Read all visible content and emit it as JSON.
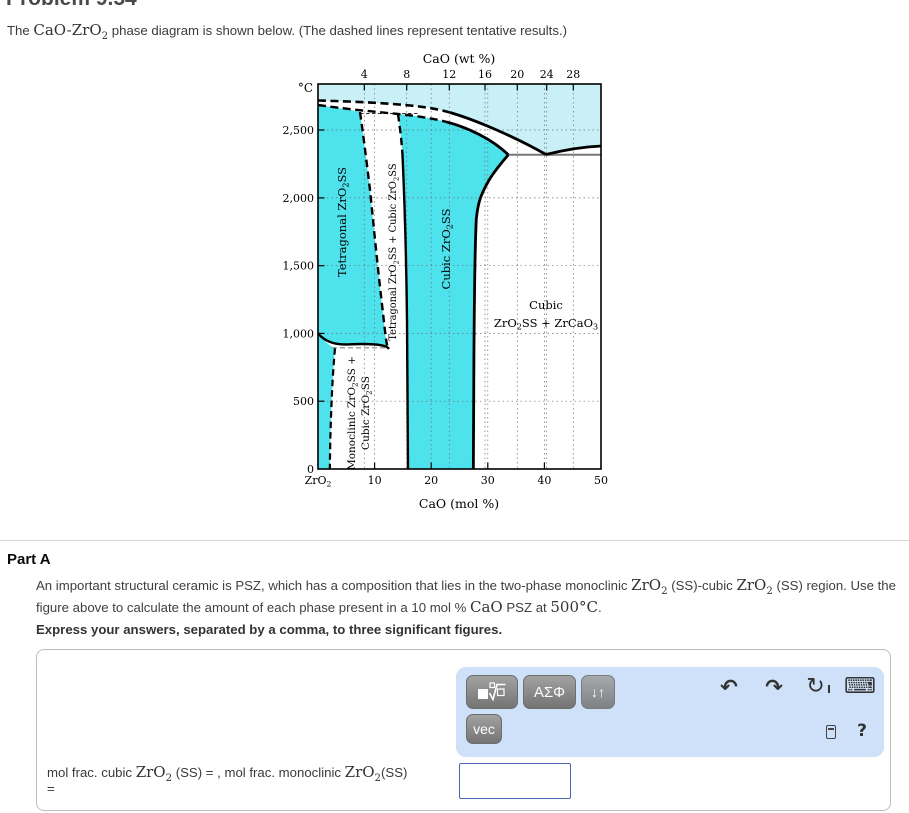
{
  "theme": {
    "cyan": "#4ee2ec",
    "cyan-light": "#c9f0f6",
    "toolbar-bg": "#cee1f8",
    "btn-top": "#a2a2a2",
    "btn-bottom": "#747474",
    "input-border": "#4a66b0",
    "icon": "#333333",
    "panel-border": "#bdbdbd"
  },
  "page": {
    "title_clipped": "Problem 9.54"
  },
  "intro": "The `CaO-ZrO_2` phase diagram is shown below. (The dashed lines represent tentative results.)",
  "figure": {
    "top_axis_title": "CaO (wt %)",
    "bottom_axis_title": "CaO (mol %)",
    "y_unit": "°C",
    "top_ticks": [
      "4",
      "8",
      "12",
      "16",
      "20",
      "24",
      "28"
    ],
    "bottom_ticks": [
      "ZrO_2",
      "10",
      "20",
      "30",
      "40",
      "50"
    ],
    "left_ticks": [
      "0",
      "500",
      "1,000",
      "1,500",
      "2,000",
      "2,500"
    ],
    "regions": {
      "tetragonal": "Tetragonal ZrO_2SS",
      "tetra_cubic": "Tetragonal ZrO_2SS + Cubic ZrO_2SS",
      "cubic": "Cubic ZrO_2SS",
      "mono_line1": "Monoclinic ZrO_2SS +",
      "mono_line2": "Cubic ZrO_2SS",
      "cubic_zrcao3_line1": "Cubic",
      "cubic_zrcao3_line2": "ZrO_2SS + ZrCaO_3"
    }
  },
  "chart_data": {
    "type": "line",
    "title": "CaO-ZrO2 phase diagram",
    "xlabel": "CaO (mol %)",
    "xlabel_top": "CaO (wt %)",
    "ylabel": "Temperature (°C)",
    "xlim": [
      0,
      50
    ],
    "ylim": [
      0,
      2840
    ],
    "x_ticks_mol": [
      0,
      10,
      20,
      30,
      40,
      50
    ],
    "x_ticks_wt": [
      4,
      8,
      12,
      16,
      20,
      24,
      28
    ],
    "y_ticks": [
      0,
      500,
      1000,
      1500,
      2000,
      2500
    ],
    "grid": true,
    "regions": [
      "Liquid",
      "Tetragonal ZrO2SS",
      "Tetragonal ZrO2SS + Cubic ZrO2SS",
      "Cubic ZrO2SS",
      "Cubic ZrO2SS + ZrCaO3",
      "Monoclinic ZrO2SS + Cubic ZrO2SS",
      "Monoclinic ZrO2SS"
    ],
    "series": [
      {
        "name": "liquidus (dashed, tentative)",
        "style": "dashed",
        "points": [
          [
            0,
            2718
          ],
          [
            8,
            2695
          ],
          [
            16,
            2672
          ],
          [
            22,
            2630
          ],
          [
            30,
            2480
          ],
          [
            40,
            2300
          ]
        ]
      },
      {
        "name": "liquidus right branch",
        "style": "solid",
        "points": [
          [
            40,
            2300
          ],
          [
            45,
            2345
          ],
          [
            50,
            2382
          ]
        ]
      },
      {
        "name": "solidus",
        "style": "dashed-then-solid",
        "points": [
          [
            0,
            2684
          ],
          [
            8,
            2650
          ],
          [
            14,
            2618
          ],
          [
            22,
            2560
          ],
          [
            28,
            2450
          ],
          [
            33.6,
            2300
          ]
        ]
      },
      {
        "name": "tetragonal solvus (dashed)",
        "style": "dashed",
        "points": [
          [
            7.4,
            2630
          ],
          [
            9,
            2050
          ],
          [
            11.5,
            1150
          ],
          [
            12.2,
            910
          ]
        ]
      },
      {
        "name": "cubic solvus",
        "style": "dashed-then-solid",
        "points": [
          [
            14.1,
            2600
          ],
          [
            14.9,
            2300
          ],
          [
            15.6,
            1500
          ],
          [
            15.8,
            500
          ],
          [
            15.9,
            0
          ]
        ]
      },
      {
        "name": "cubic right boundary",
        "style": "solid",
        "points": [
          [
            33.6,
            2300
          ],
          [
            29.8,
            2100
          ],
          [
            28,
            2000
          ],
          [
            27.6,
            1500
          ],
          [
            27.4,
            0
          ]
        ]
      },
      {
        "name": "monoclinic-tetragonal boundary",
        "style": "solid",
        "points": [
          [
            0,
            1000
          ],
          [
            5,
            925
          ],
          [
            12.5,
            905
          ]
        ]
      },
      {
        "name": "monoclinic solvus (dashed)",
        "style": "dashed",
        "points": [
          [
            3,
            890
          ],
          [
            2.1,
            500
          ],
          [
            2.1,
            0
          ]
        ]
      },
      {
        "name": "eutectoid isotherm ~900°C (dashed)",
        "style": "dashed",
        "points": [
          [
            2.5,
            900
          ],
          [
            12.5,
            900
          ]
        ]
      },
      {
        "name": "isotherm 2300°C",
        "style": "solid",
        "points": [
          [
            33.6,
            2300
          ],
          [
            50,
            2300
          ]
        ]
      }
    ]
  },
  "part_a": {
    "heading": "Part A",
    "question": "An important structural ceramic is PSZ, which has a composition that lies in the two-phase monoclinic `ZrO_2` (SS)-cubic `ZrO_2` (SS) region. Use the figure above to calculate the amount of each phase present in a 10 mol % `CaO` PSZ at `500°C`.",
    "express": "Express your answers, separated by a comma, to three significant figures."
  },
  "toolbar": {
    "greek_label": "ΑΣΦ",
    "updown_label": "↓↑",
    "vec_label": "vec",
    "undo_icon": "↶",
    "redo_icon": "↷",
    "reset_icon": "↻",
    "keyboard_icon": "⌨",
    "help_label": "?"
  },
  "answer": {
    "label": "mol frac. cubic `ZrO_2` (SS) = , mol frac. monoclinic `ZrO_2`(SS)",
    "label_line2": "=",
    "input_value": "",
    "input_placeholder": ""
  }
}
